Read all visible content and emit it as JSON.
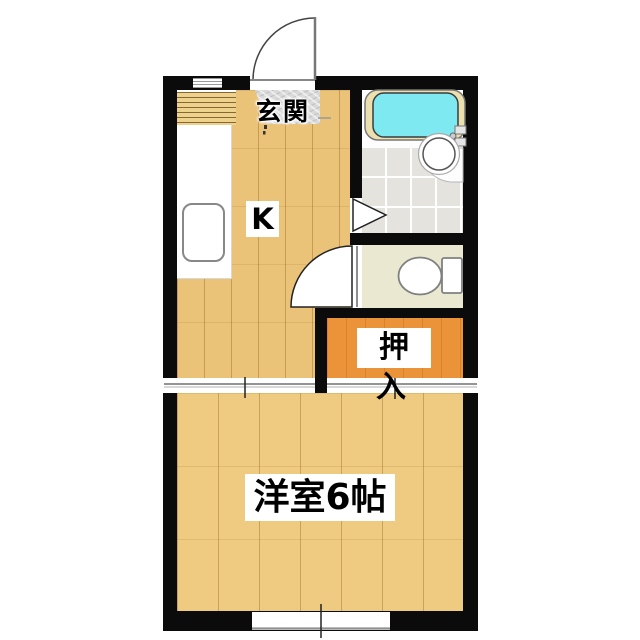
{
  "floorplan": {
    "type": "apartment-floorplan",
    "labels": {
      "entrance": "玄関",
      "kitchen": "K",
      "closet": "押入",
      "western_room": "洋室6帖"
    },
    "colors": {
      "wall": "#0b0b0b",
      "kitchen_floor": "#eac378",
      "western_room_floor": "#eecb81",
      "closet": "#eb9338",
      "toilet_floor": "#eae8d1",
      "bathroom_tile": "#e4e3de",
      "bathtub_water": "#7ee9f1",
      "tub_surround": "#ece0ae",
      "entrance_stone": "#d9d9d9",
      "background": "#ffffff"
    },
    "fixtures": [
      "entrance-swing-door",
      "bathtub",
      "wash-basin",
      "toilet",
      "bathroom-folding-door-mark",
      "toilet-swing-door",
      "sliding-door-kitchen-western",
      "sliding-door-closet",
      "window-south",
      "wall-vent",
      "kitchen-counter-sink",
      "shoe-shelf"
    ]
  }
}
